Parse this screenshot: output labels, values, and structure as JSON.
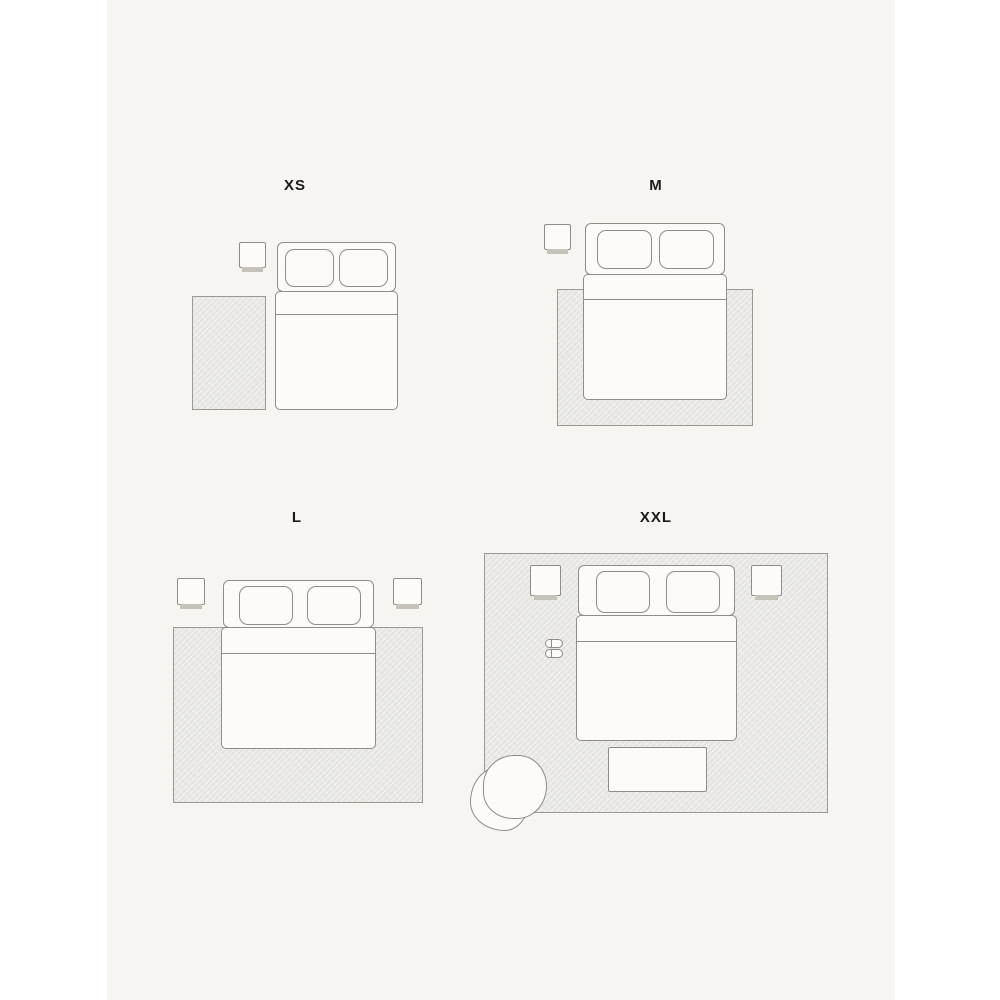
{
  "page": {
    "type": "rug-size-guide-illustration",
    "background": "#ffffff",
    "canvas_background": "#f6f5f2"
  },
  "colors": {
    "outline": "#8e8d88",
    "rug_border": "#9a9994",
    "rug_fill": "#e5e4e1",
    "furniture_fill": "#fcfbf9",
    "nightstand_shadow": "#c6c2ba",
    "label_text": "#1a1a1a"
  },
  "panels": [
    {
      "id": "xs",
      "label": "XS",
      "furniture": [
        "rug-beside-bed",
        "nightstand",
        "double-bed",
        "pillow",
        "pillow"
      ]
    },
    {
      "id": "m",
      "label": "M",
      "furniture": [
        "rug-under-lower-bed",
        "nightstand",
        "double-bed",
        "pillow",
        "pillow"
      ]
    },
    {
      "id": "l",
      "label": "L",
      "furniture": [
        "rug-under-bed",
        "nightstand-left",
        "nightstand-right",
        "double-bed",
        "pillow",
        "pillow"
      ]
    },
    {
      "id": "xxl",
      "label": "XXL",
      "furniture": [
        "room-size-rug",
        "nightstand-left",
        "nightstand-right",
        "double-bed",
        "pillow",
        "pillow",
        "slippers",
        "bench",
        "armchair"
      ]
    }
  ]
}
